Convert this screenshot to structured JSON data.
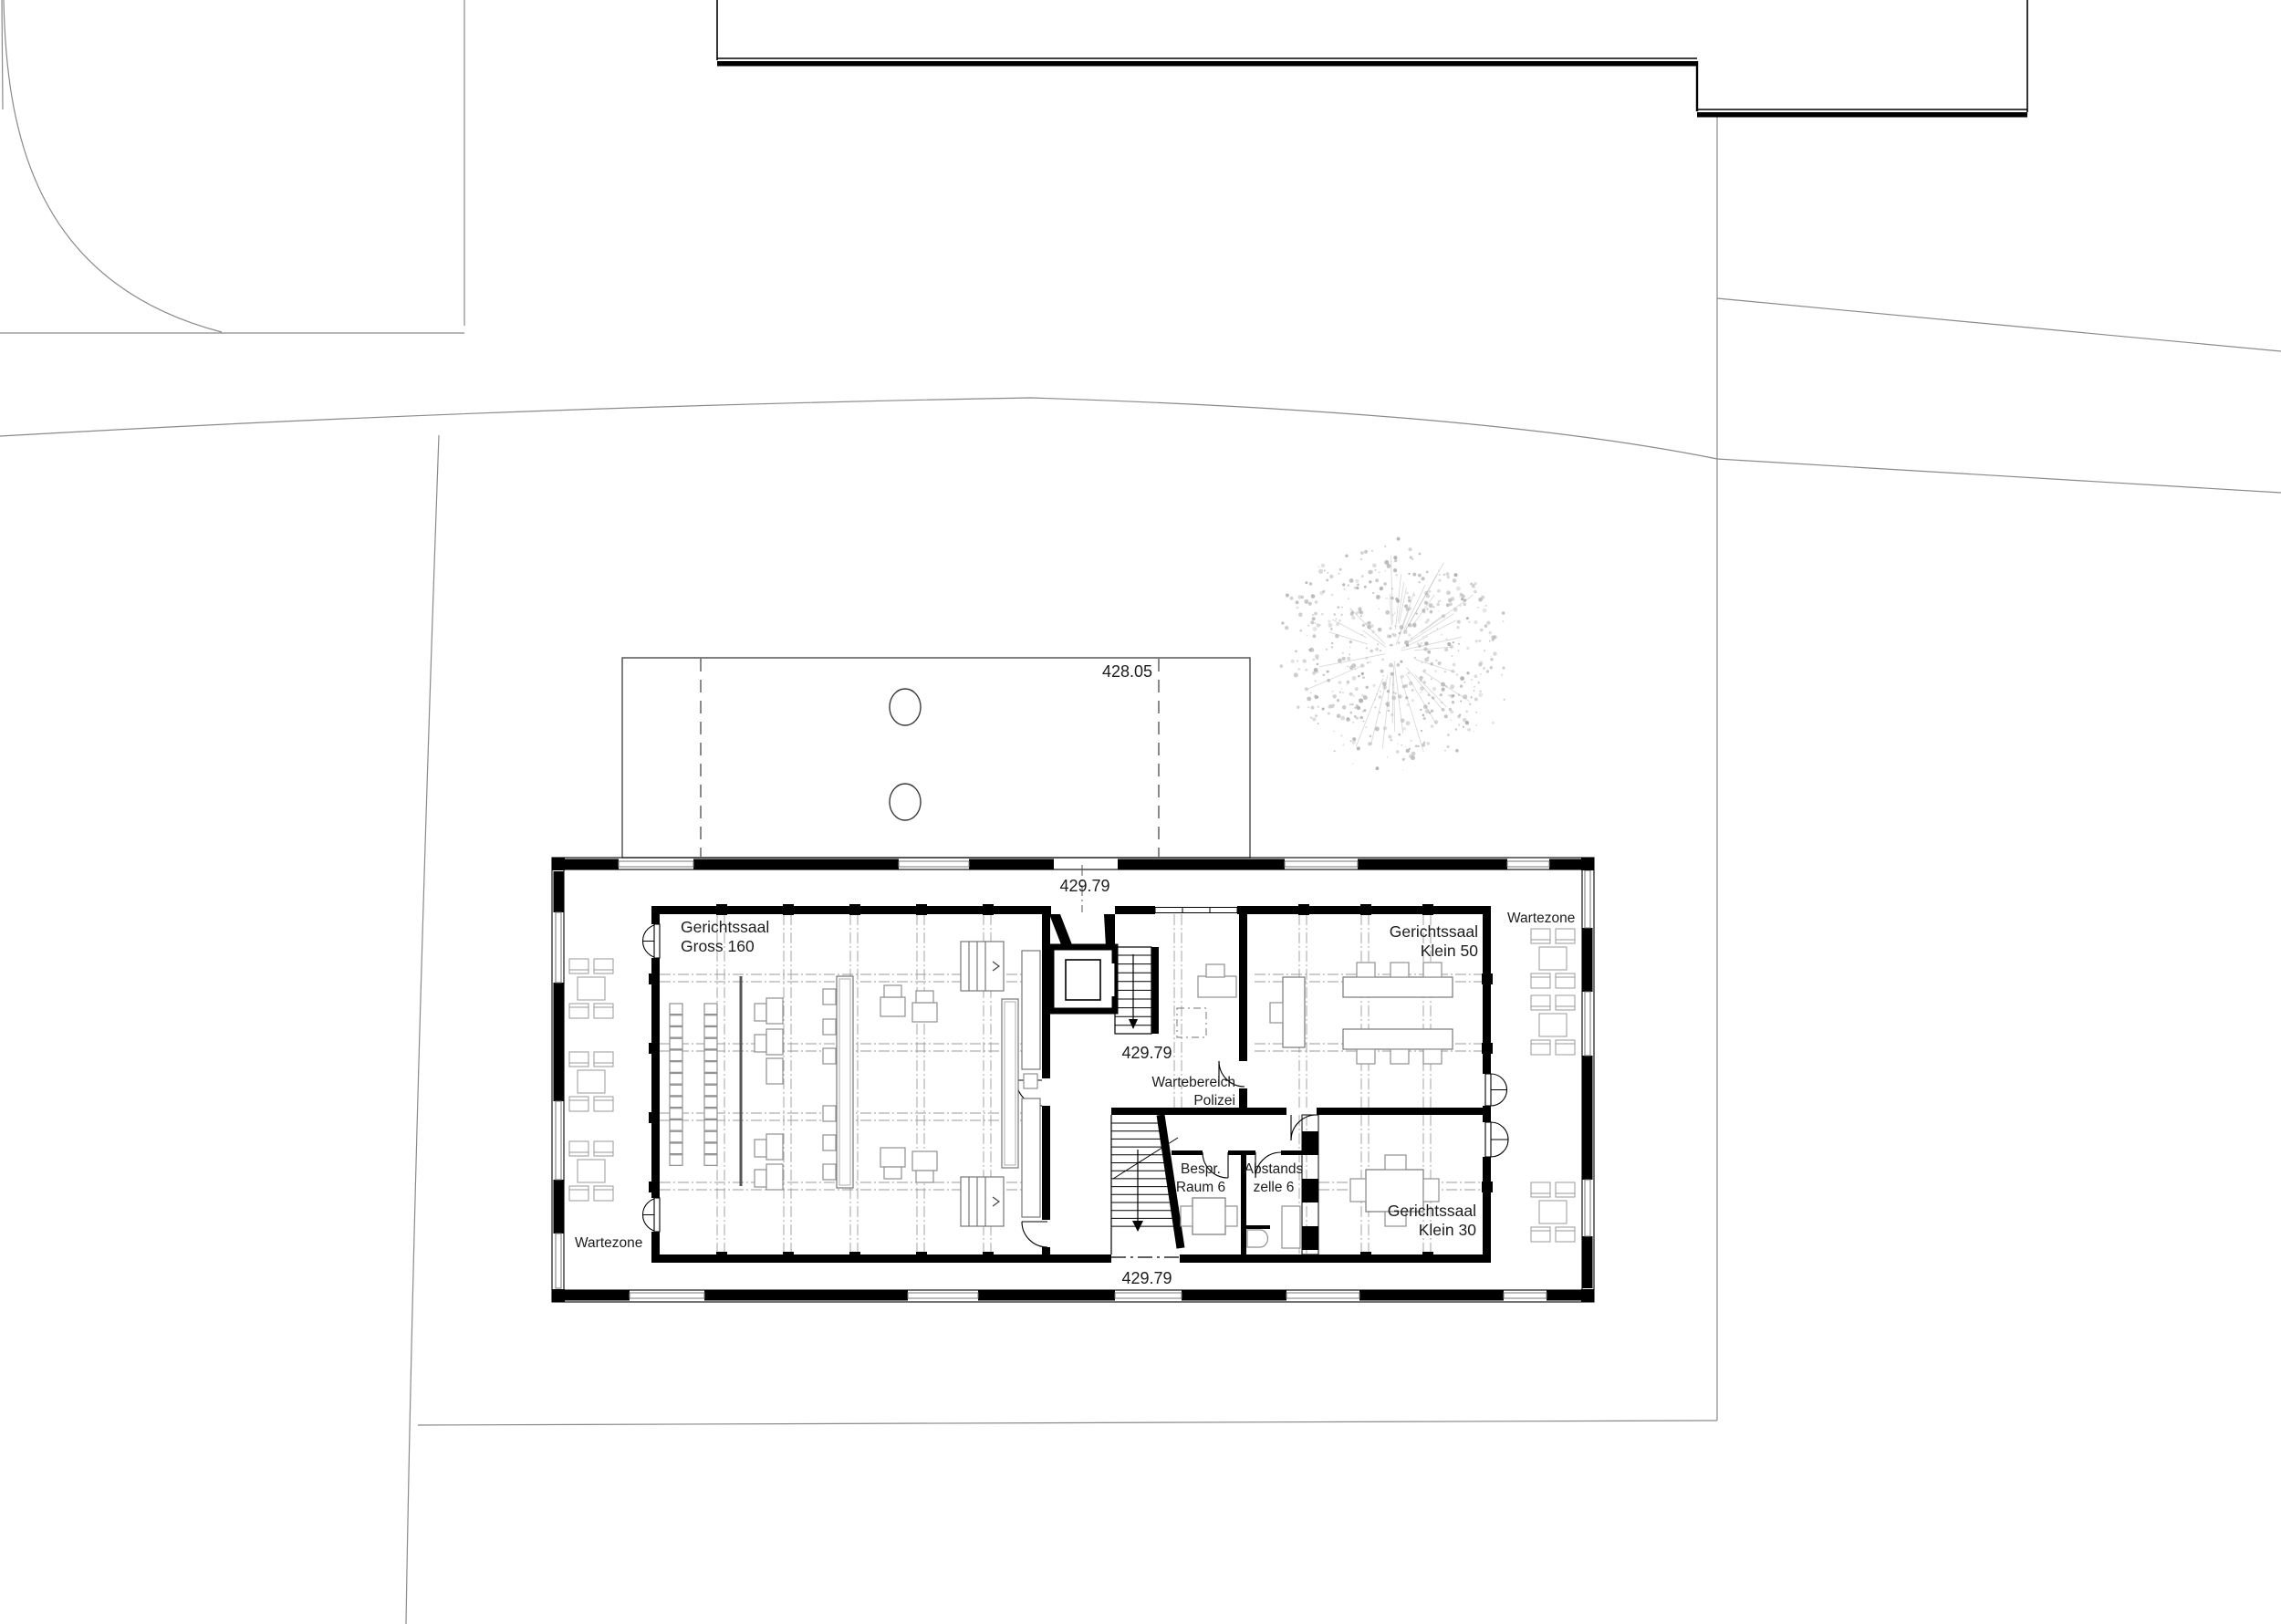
{
  "page": {
    "title": "Gerichtsgebaeude Erdgeschoss Situationsplan",
    "background": "#ffffff",
    "ink": "#000000",
    "furniture_gray": "#8f8f8f",
    "axis_gray": "#9b9b9b",
    "site_line_gray": "#8a8a8a",
    "tree_gray": "#b3b3b3"
  },
  "levels": {
    "terrace": "428.05",
    "entry_top": "429.79",
    "core": "429.79",
    "bottom": "429.79"
  },
  "rooms": {
    "main_court": {
      "line1": "Gerichtssaal",
      "line2": "Gross 160"
    },
    "small_court_50": {
      "line1": "Gerichtssaal",
      "line2": "Klein 50"
    },
    "small_court_30": {
      "line1": "Gerichtssaal",
      "line2": "Klein 30"
    },
    "meeting_room": {
      "line1": "Bespr.",
      "line2": "Raum 6"
    },
    "holding_cell": {
      "line1": "Abstands",
      "line2": "zelle 6"
    },
    "police_wait": {
      "line1": "Wartebereich",
      "line2": "Polizei"
    },
    "wait_zone_left": "Wartezone",
    "wait_zone_right": "Wartezone"
  },
  "icons": {
    "tree": "tree-icon",
    "stairs_upper": "stairs-down-icon",
    "stairs_lower": "stairs-down-icon",
    "elevator": "elevator-icon"
  }
}
